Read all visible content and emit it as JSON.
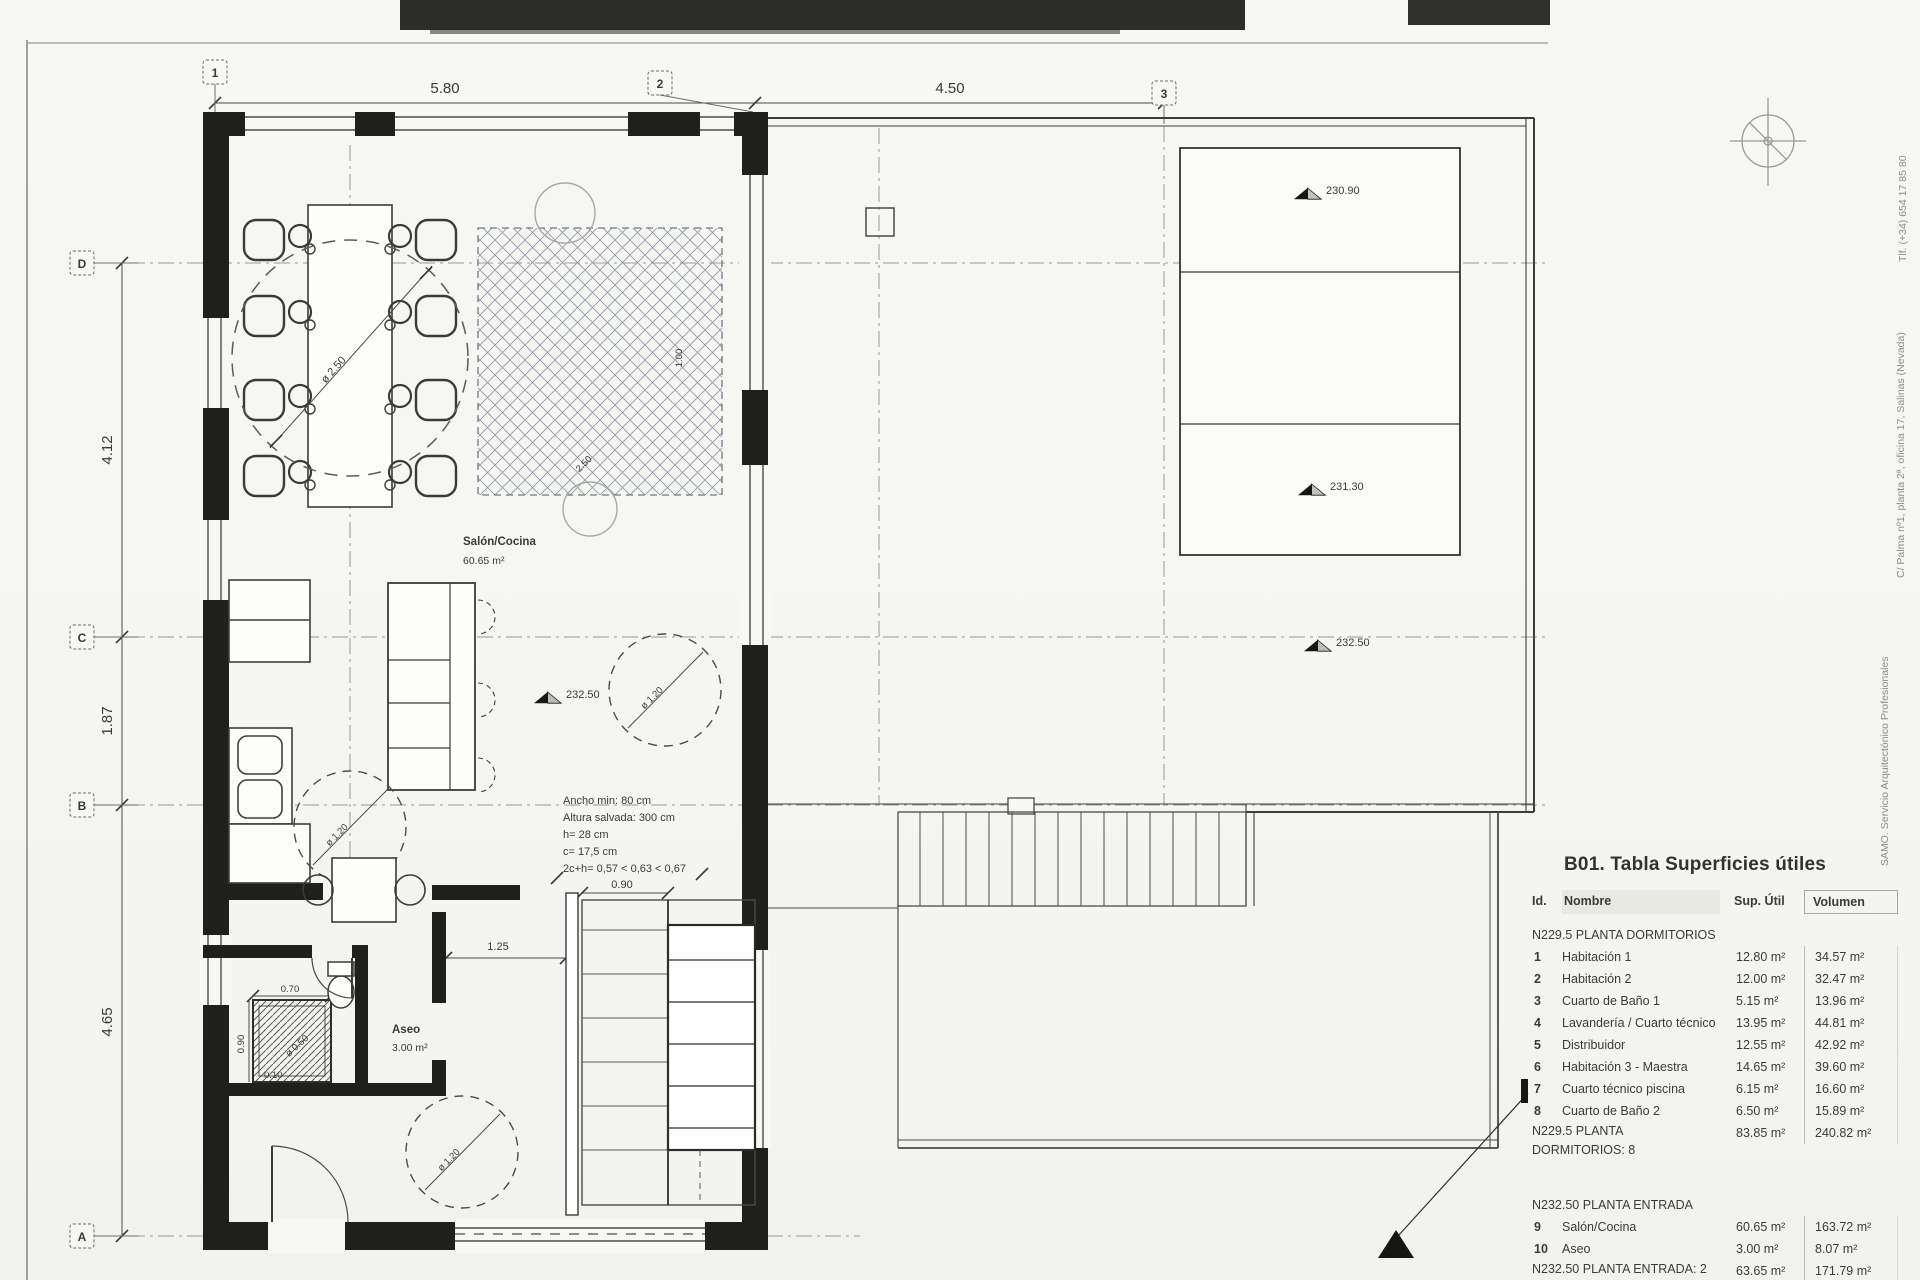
{
  "plan": {
    "grid": {
      "c1": "1",
      "c2": "2",
      "c3": "3",
      "rD": "D",
      "rC": "C",
      "rB": "B",
      "rA": "A"
    },
    "dims": {
      "top1": "5.80",
      "top2": "4.50",
      "left1": "4.12",
      "left2": "1.87",
      "left3": "4.65",
      "hall": "1.25",
      "stair": "0.90",
      "rug_w": "2.50",
      "rug_h": "1.00",
      "table_circle": "ø 2.50",
      "circle120": "ø 1.20",
      "shower_w": "0.70",
      "shower_h": "0.90",
      "shower_d": "ø 0.50",
      "shower_o": "0.10"
    },
    "levels": {
      "l1": "230.90",
      "l2": "231.30",
      "l3": "232.50"
    },
    "rooms": {
      "salon_name": "Salón/Cocina",
      "salon_area": "60.65 m²",
      "aseo_name": "Aseo",
      "aseo_area": "3.00 m²"
    },
    "note": {
      "l1": "Ancho min: 80 cm",
      "l2": "Altura salvada: 300 cm",
      "l3": "h= 28 cm",
      "l4": "c= 17,5 cm",
      "l5": "2c+h= 0,57 < 0,63 < 0,67"
    },
    "margin": {
      "phone": "Tlf. (+34) 654 17 85 80",
      "address": "C/ Palma nº1, planta 2ª, oficina 17, Salinas (Nevada)",
      "firm": "SAMO. Servicio Arquitectónico Profesionales"
    }
  },
  "table": {
    "title": "B01. Tabla Superficies útiles",
    "headers": {
      "id": "Id.",
      "name": "Nombre",
      "sup": "Sup. Útil",
      "vol": "Volumen"
    },
    "s1": {
      "label": "N229.5 PLANTA DORMITORIOS",
      "rows": [
        {
          "id": "1",
          "name": "Habitación 1",
          "sup": "12.80 m²",
          "vol": "34.57 m²"
        },
        {
          "id": "2",
          "name": "Habitación 2",
          "sup": "12.00 m²",
          "vol": "32.47 m²"
        },
        {
          "id": "3",
          "name": "Cuarto de Baño 1",
          "sup": "5.15 m²",
          "vol": "13.96 m²"
        },
        {
          "id": "4",
          "name": "Lavandería / Cuarto técnico",
          "sup": "13.95 m²",
          "vol": "44.81 m²"
        },
        {
          "id": "5",
          "name": "Distribuidor",
          "sup": "12.55 m²",
          "vol": "42.92 m²"
        },
        {
          "id": "6",
          "name": "Habitación 3 - Maestra",
          "sup": "14.65 m²",
          "vol": "39.60 m²"
        },
        {
          "id": "7",
          "name": "Cuarto técnico piscina",
          "sup": "6.15 m²",
          "vol": "16.60 m²"
        },
        {
          "id": "8",
          "name": "Cuarto de Baño 2",
          "sup": "6.50 m²",
          "vol": "15.89 m²"
        }
      ],
      "subtotal": {
        "label": "N229.5 PLANTA DORMITORIOS: 8",
        "sup": "83.85 m²",
        "vol": "240.82 m²"
      }
    },
    "s2": {
      "label": "N232.50 PLANTA ENTRADA",
      "rows": [
        {
          "id": "9",
          "name": "Salón/Cocina",
          "sup": "60.65 m²",
          "vol": "163.72 m²"
        },
        {
          "id": "10",
          "name": "Aseo",
          "sup": "3.00 m²",
          "vol": "8.07 m²"
        }
      ],
      "subtotal": {
        "label": "N232.50 PLANTA ENTRADA: 2",
        "sup": "63.65 m²",
        "vol": "171.79 m²"
      }
    },
    "total": {
      "label": "Total",
      "sup": "147.50 m²",
      "vol": "412.62 m²"
    }
  }
}
